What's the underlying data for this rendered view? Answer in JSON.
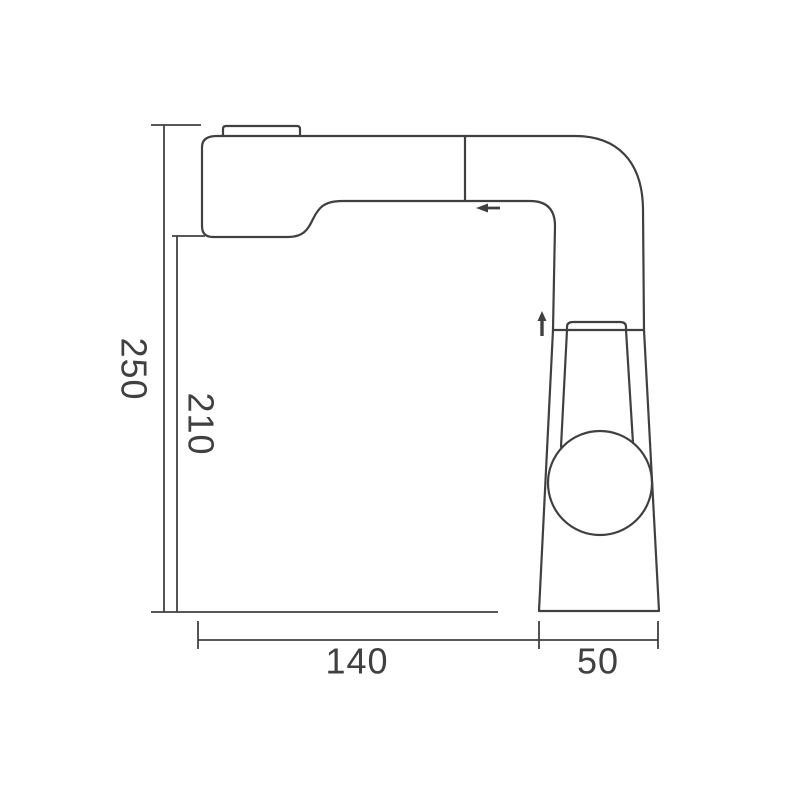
{
  "drawing": {
    "type": "technical-dimension-drawing",
    "subject": "pull-out basin faucet side profile",
    "line_color": "#404040",
    "background_color": "#ffffff",
    "dimensions": {
      "overall_height": "250",
      "spout_height": "210",
      "spout_reach": "140",
      "base_width": "50"
    }
  }
}
